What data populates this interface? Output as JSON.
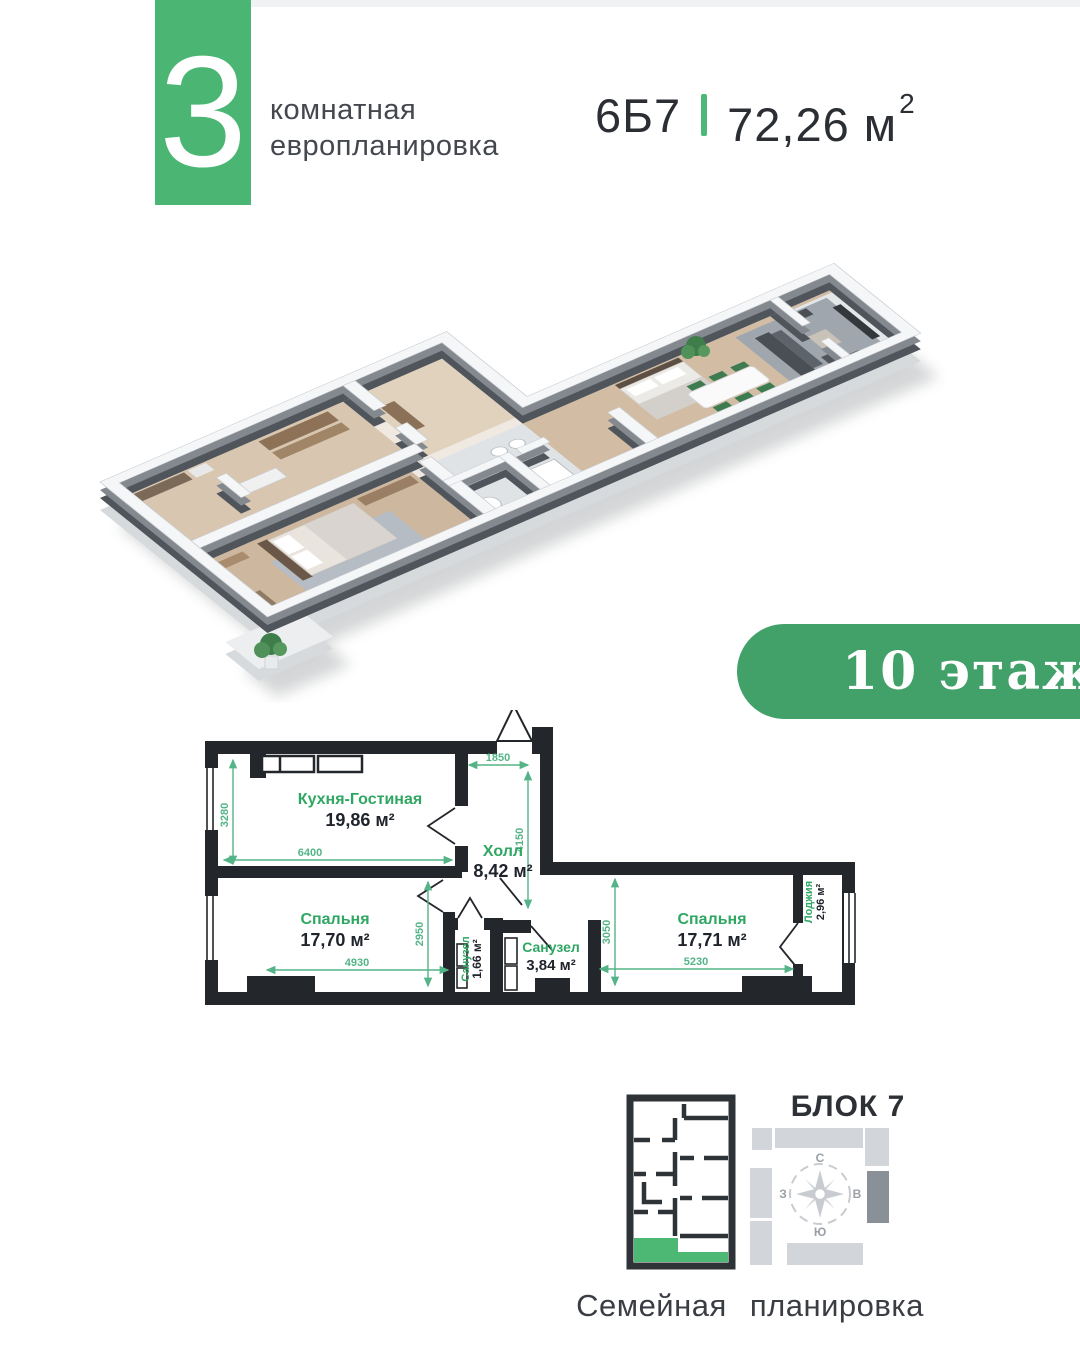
{
  "header": {
    "rooms_number": "3",
    "rooms_label_line1": "комнатная",
    "rooms_label_line2": "европланировка",
    "unit_code": "6Б7",
    "area_value": "72,26 м",
    "area_sup": "2"
  },
  "floor_badge": "10 этаж",
  "plan": {
    "rooms": [
      {
        "name": "Кухня-Гостиная",
        "area": "19,86 м²"
      },
      {
        "name": "Холл",
        "area": "8,42 м²"
      },
      {
        "name": "Спальня",
        "area": "17,70 м²"
      },
      {
        "name": "Санузел",
        "area": "1,66 м²"
      },
      {
        "name": "Санузел",
        "area": "3,84 м²"
      },
      {
        "name": "Спальня",
        "area": "17,71 м²"
      },
      {
        "name": "Лоджия",
        "area": "2,96 м²"
      }
    ],
    "dims": {
      "left_v": "3280",
      "kitchen_w": "6400",
      "entrance_w": "1850",
      "hall_v": "4150",
      "bedroom1_v": "2950",
      "bedroom1_w": "4930",
      "bedroom2_v": "3050",
      "bedroom2_w": "5230"
    }
  },
  "footer": {
    "block_label": "БЛОК 7",
    "compass": {
      "n": "С",
      "s": "Ю",
      "w": "З",
      "e": "В"
    },
    "caption": "Семейная планировка"
  },
  "colors": {
    "brand_green": "#4bb673",
    "badge_green": "#41a169",
    "plan_label_green": "#2fa763",
    "dim_green": "#55b487",
    "wall_dark": "#23262b"
  }
}
